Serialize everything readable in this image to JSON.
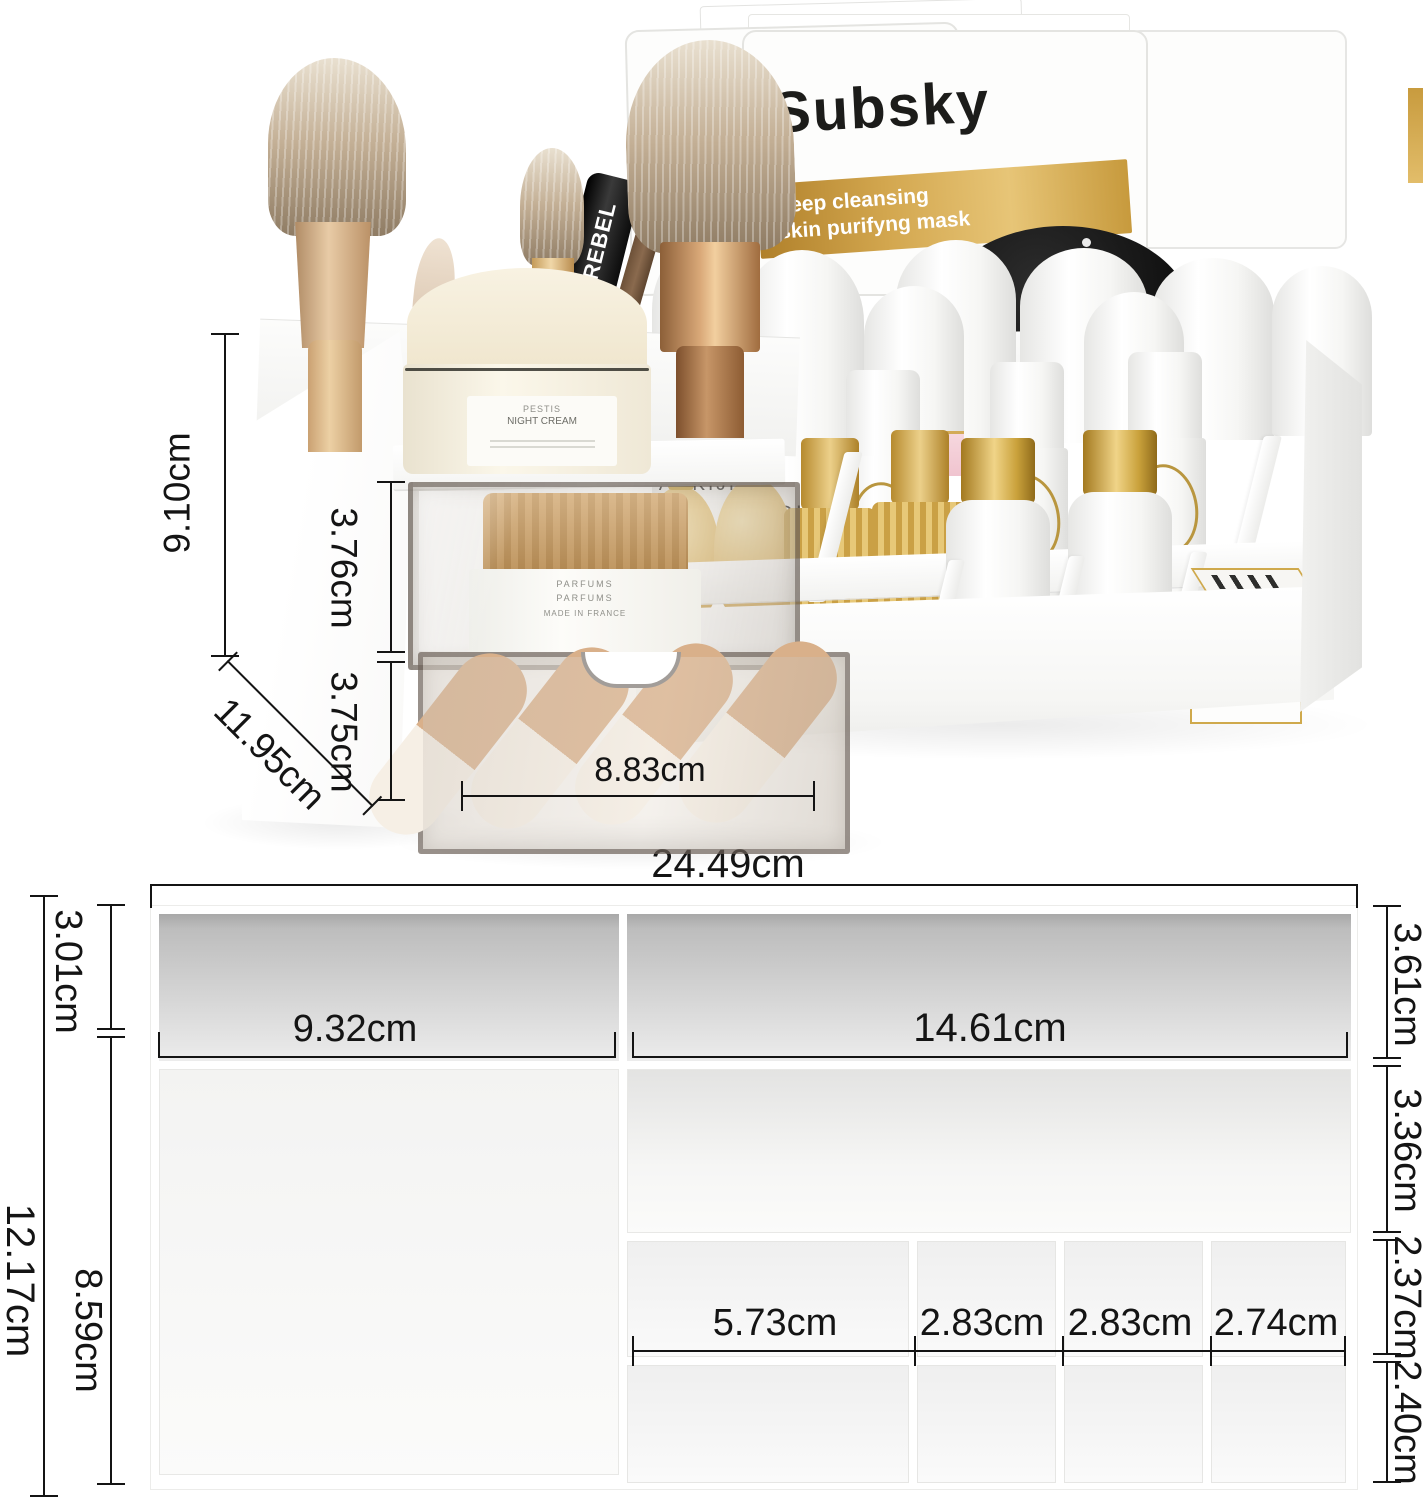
{
  "photo": {
    "masks": {
      "brand": "Subsky",
      "line1": "deep cleansing",
      "line2": "skin purifyng mask"
    },
    "products": {
      "mascara": "REBEL",
      "bottle_left": "AOKIJI",
      "bottle_right": "AOKIJI",
      "lotion_left": "BABOR",
      "lotion_right": "BABOR",
      "cream_jar_line1": "PESTIS",
      "cream_jar_line2": "NIGHT CREAM",
      "drawer_jar_line1": "PARFUMS",
      "drawer_jar_line2": "PARFUMS",
      "drawer_jar_line3": "MADE IN FRANCE"
    },
    "dims": {
      "height": "9.10cm",
      "drawer1_height": "3.76cm",
      "drawer2_height": "3.75cm",
      "depth": "11.95cm",
      "drawer_width": "8.83cm"
    }
  },
  "diagram": {
    "dims": {
      "total_width": "24.49cm",
      "total_depth": "12.17cm",
      "left_back_depth": "3.01cm",
      "left_main_depth": "8.59cm",
      "left_width": "9.32cm",
      "right_width": "14.61cm",
      "right_back_depth": "3.61cm",
      "right_mid_depth": "3.36cm",
      "cell_row1_depth": "2.37cm",
      "cell_row2_depth": "2.40cm",
      "col1_width": "5.73cm",
      "col2_width": "2.83cm",
      "col3_width": "2.83cm",
      "col4_width": "2.74cm"
    }
  },
  "colors": {
    "gold_band": "#c79a3d",
    "gold_cap": "#d4af5e",
    "dimension_line": "#141414"
  }
}
